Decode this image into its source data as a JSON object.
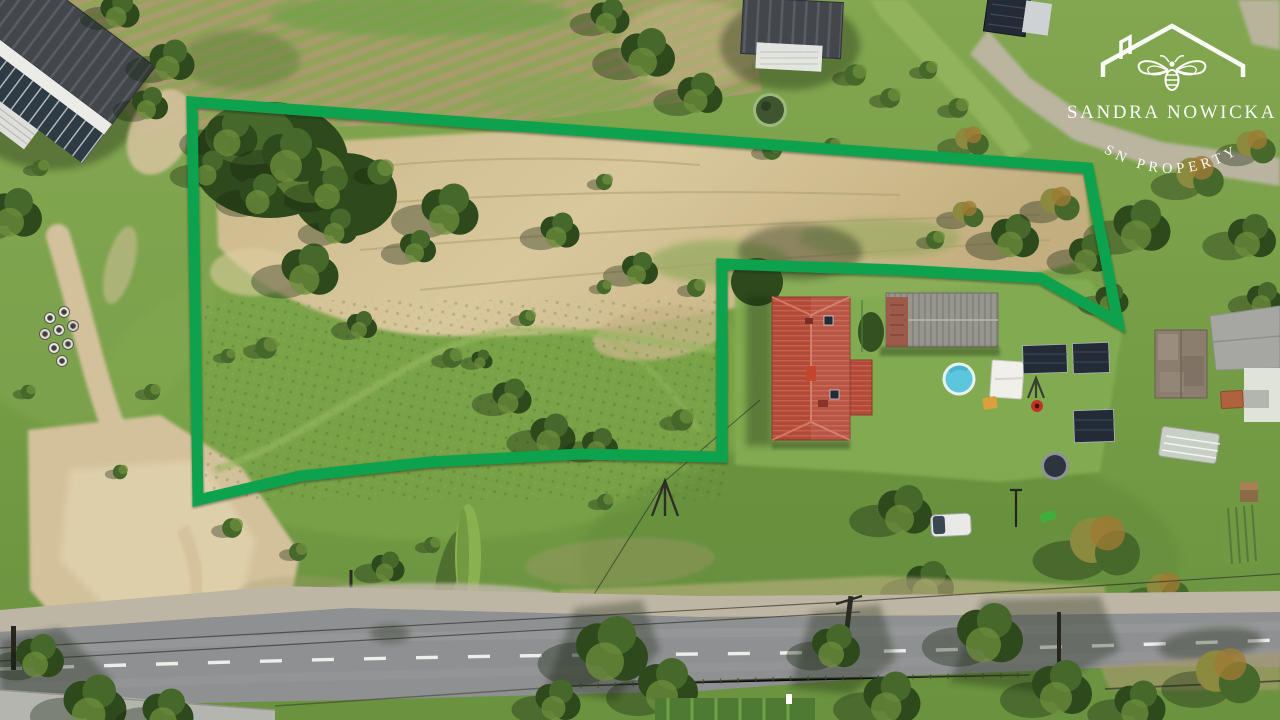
{
  "watermark": {
    "brand_name": "SANDRA NOWICKA",
    "brand_subtitle": "SN PROPERTY",
    "icon": "roof-with-chimney-and-bee-logo",
    "text_color": "#ffffff"
  },
  "property_boundary": {
    "color": "#0aa24d",
    "stroke_width": 11,
    "points": "192,102 1088,168 1118,322 1040,278 900,270 722,264 722,457 580,454 430,462 300,476 198,500"
  },
  "palette": {
    "boundary_green": "#0aa24d",
    "grass_base": "#7aa14a",
    "grass_light": "#96b75f",
    "grass_dark": "#5d8038",
    "lawn": "#84ad52",
    "straw": "#c7b587",
    "straw_light": "#dccd9f",
    "straw_dark": "#a89c6d",
    "tree_dark": "#2e4a1d",
    "tree_mid": "#47682b",
    "tree_light": "#6d8f3c",
    "tree_autumn": "#8c8a3f",
    "tree_orange": "#9d7a35",
    "shadow": "#14220d",
    "road_asphalt": "#8f9092",
    "road_light": "#a6a7a9",
    "road_marking": "#f2f2ef",
    "gravel": "#bdb6a4",
    "sand": "#d3c19b",
    "sand_light": "#e2d4b1",
    "pavement": "#b5b5b0",
    "roof_red": "#b24a3a",
    "roof_red_light": "#c6604b",
    "roof_gray": "#97968e",
    "roof_gray_dark": "#85847c",
    "brick": "#9c5a49",
    "roof_dark": "#43474c",
    "roof_panel_line": "#585d63",
    "roof_glass": "#2f3b44",
    "wall_white": "#ebebe8",
    "pool_water": "#5cc6dc",
    "pool_rim": "#e9f1f1",
    "solar": "#222b36",
    "tent_white": "#f0efe9",
    "trampoline": "#2c3440",
    "car_white": "#e9eae6",
    "grill_red": "#c03427",
    "play_green": "#3fae3a",
    "roof_weathered": "#8b7e6e",
    "roof_big_gray": "#a6a7a2",
    "greenhouse": "#cdd3cc",
    "shed_orange": "#b0623f",
    "wood": "#8a6b46",
    "pond": "#3f5530",
    "white": "#ffffff"
  }
}
